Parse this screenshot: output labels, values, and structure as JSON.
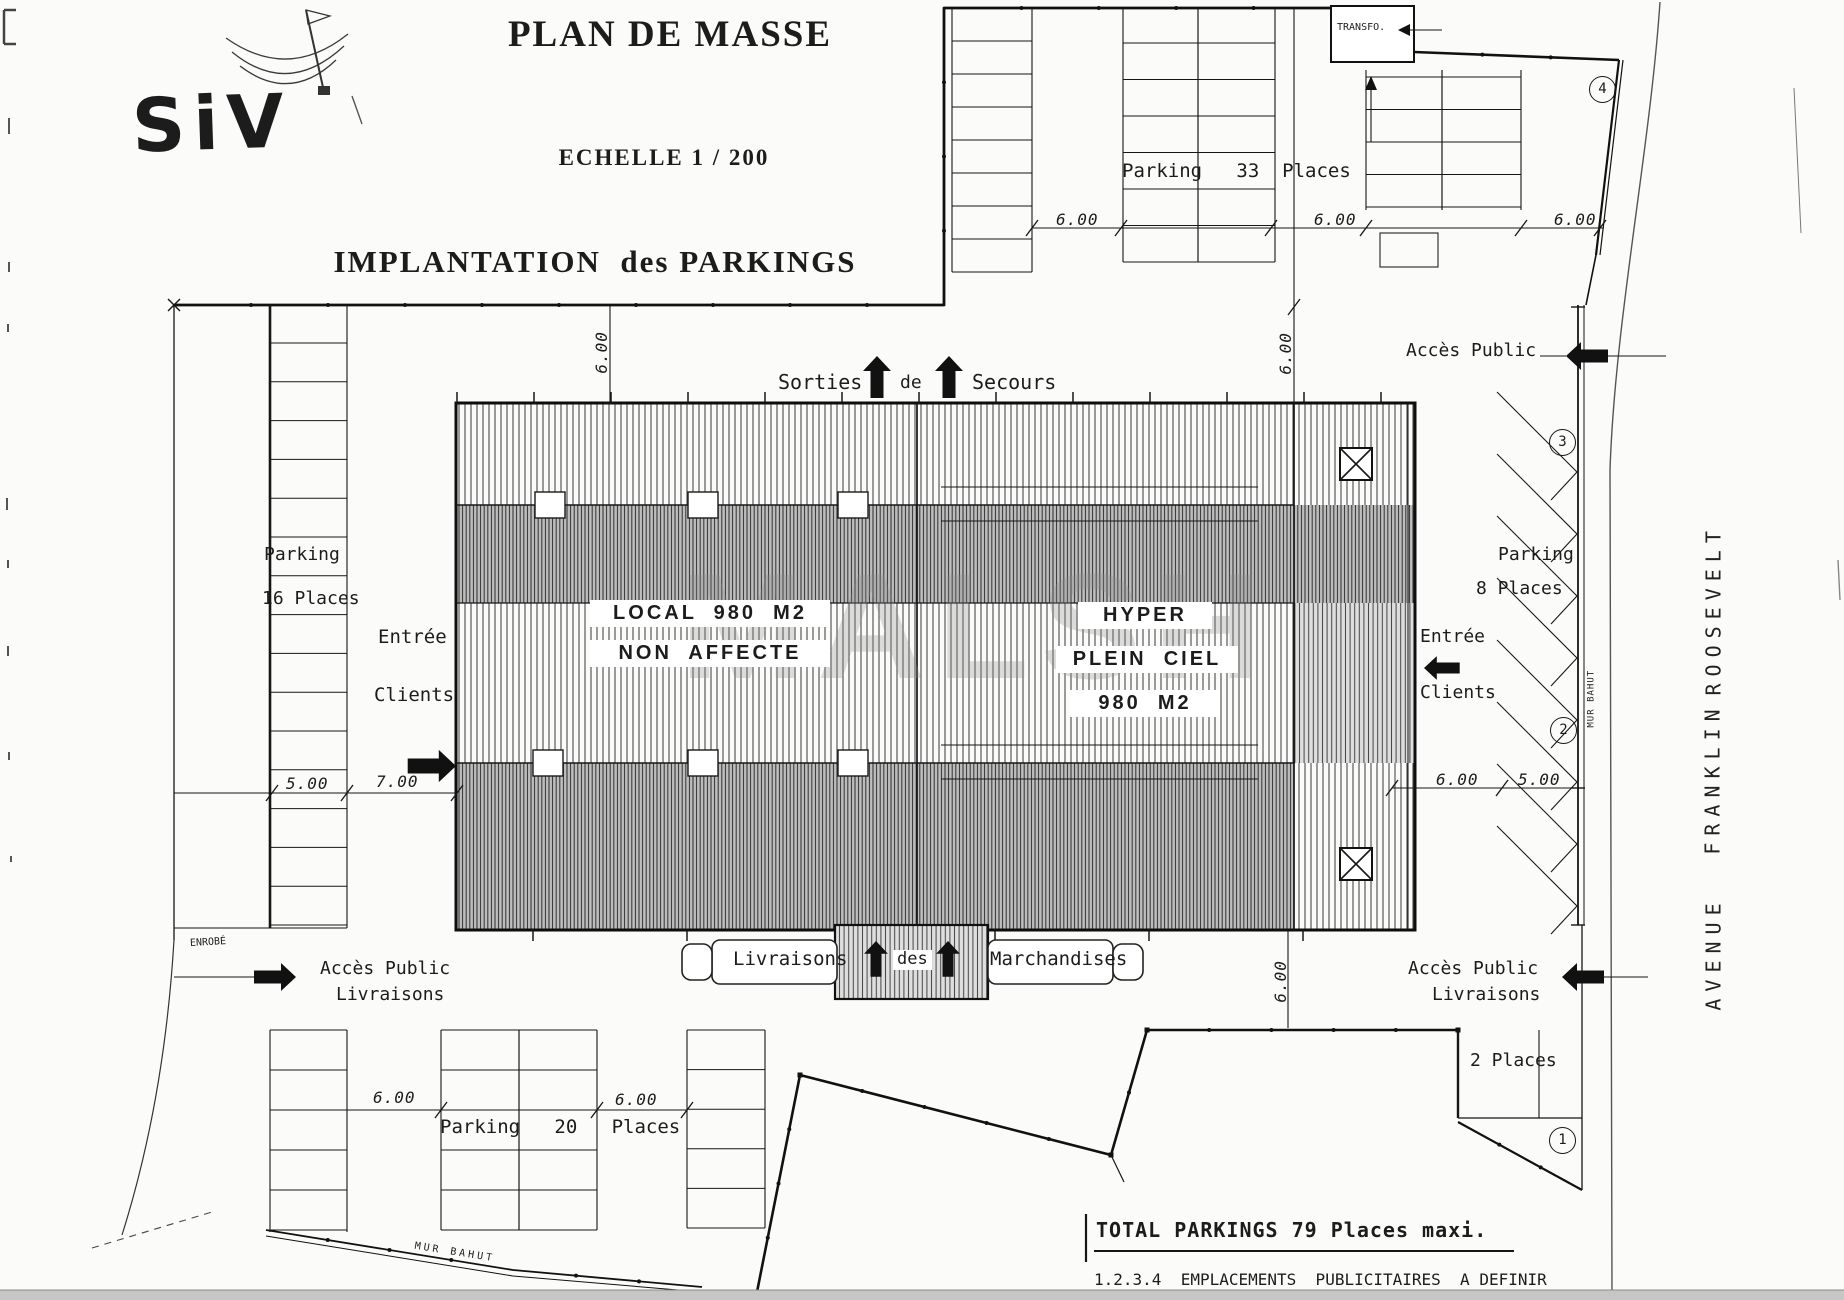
{
  "logo": "SiV",
  "titles": {
    "main": "PLAN DE MASSE",
    "scale": "ECHELLE 1 / 200",
    "sub": "IMPLANTATION  des PARKINGS"
  },
  "watermark": "MALSH",
  "building": {
    "local1": "LOCAL  980  M2",
    "local2": "NON  AFFECTE",
    "hyper1": "HYPER",
    "hyper2": "PLEIN  CIEL",
    "hyper3": "980  M2"
  },
  "exits": {
    "w1": "Sorties",
    "w2": "de",
    "w3": "Secours"
  },
  "delivery": {
    "w1": "Livraisons",
    "w2": "des",
    "w3": "Marchandises"
  },
  "parking": {
    "p33": "Parking   33  Places",
    "p16l1": "Parking",
    "p16l2": "16 Places",
    "p8l1": "Parking",
    "p8l2": "8 Places",
    "p20": "Parking   20   Places",
    "p2": "2 Places"
  },
  "access": {
    "top_right": "Accès Public",
    "bottom_right1": "Accès Public",
    "bottom_right2": "Livraisons",
    "left1": "Accès Public",
    "left2": "Livraisons"
  },
  "entry_left": {
    "l1": "Entrée",
    "l2": "Clients"
  },
  "entry_right": {
    "l1": "Entrée",
    "l2": "Clients"
  },
  "streets": {
    "avenue": "AVENUE",
    "franklin": "FRANKLIN",
    "roosevelt": "ROOSEVELT"
  },
  "notes": {
    "transfo": "TRANSFO.",
    "mur_right": "MUR BAHUT",
    "mur_bottom": "MUR BAHUT",
    "enrobe": "ENROBÉ",
    "total": "TOTAL PARKINGS 79 Places maxi.",
    "publicity": "1.2.3.4  EMPLACEMENTS  PUBLICITAIRES  A DEFINIR"
  },
  "markers": {
    "m1": "1",
    "m2": "2",
    "m3": "3",
    "m4": "4"
  },
  "dims": {
    "top1": "6.00",
    "top2": "6.00",
    "top3": "6.00",
    "aisle_left": "6.00",
    "aisle_right_top": "6.00",
    "aisle_right_bottom": "6.00",
    "left_5": "5.00",
    "left_7": "7.00",
    "right_6": "6.00",
    "right_5": "5.00",
    "bottom_1": "6.00",
    "bottom_2": "6.00"
  }
}
